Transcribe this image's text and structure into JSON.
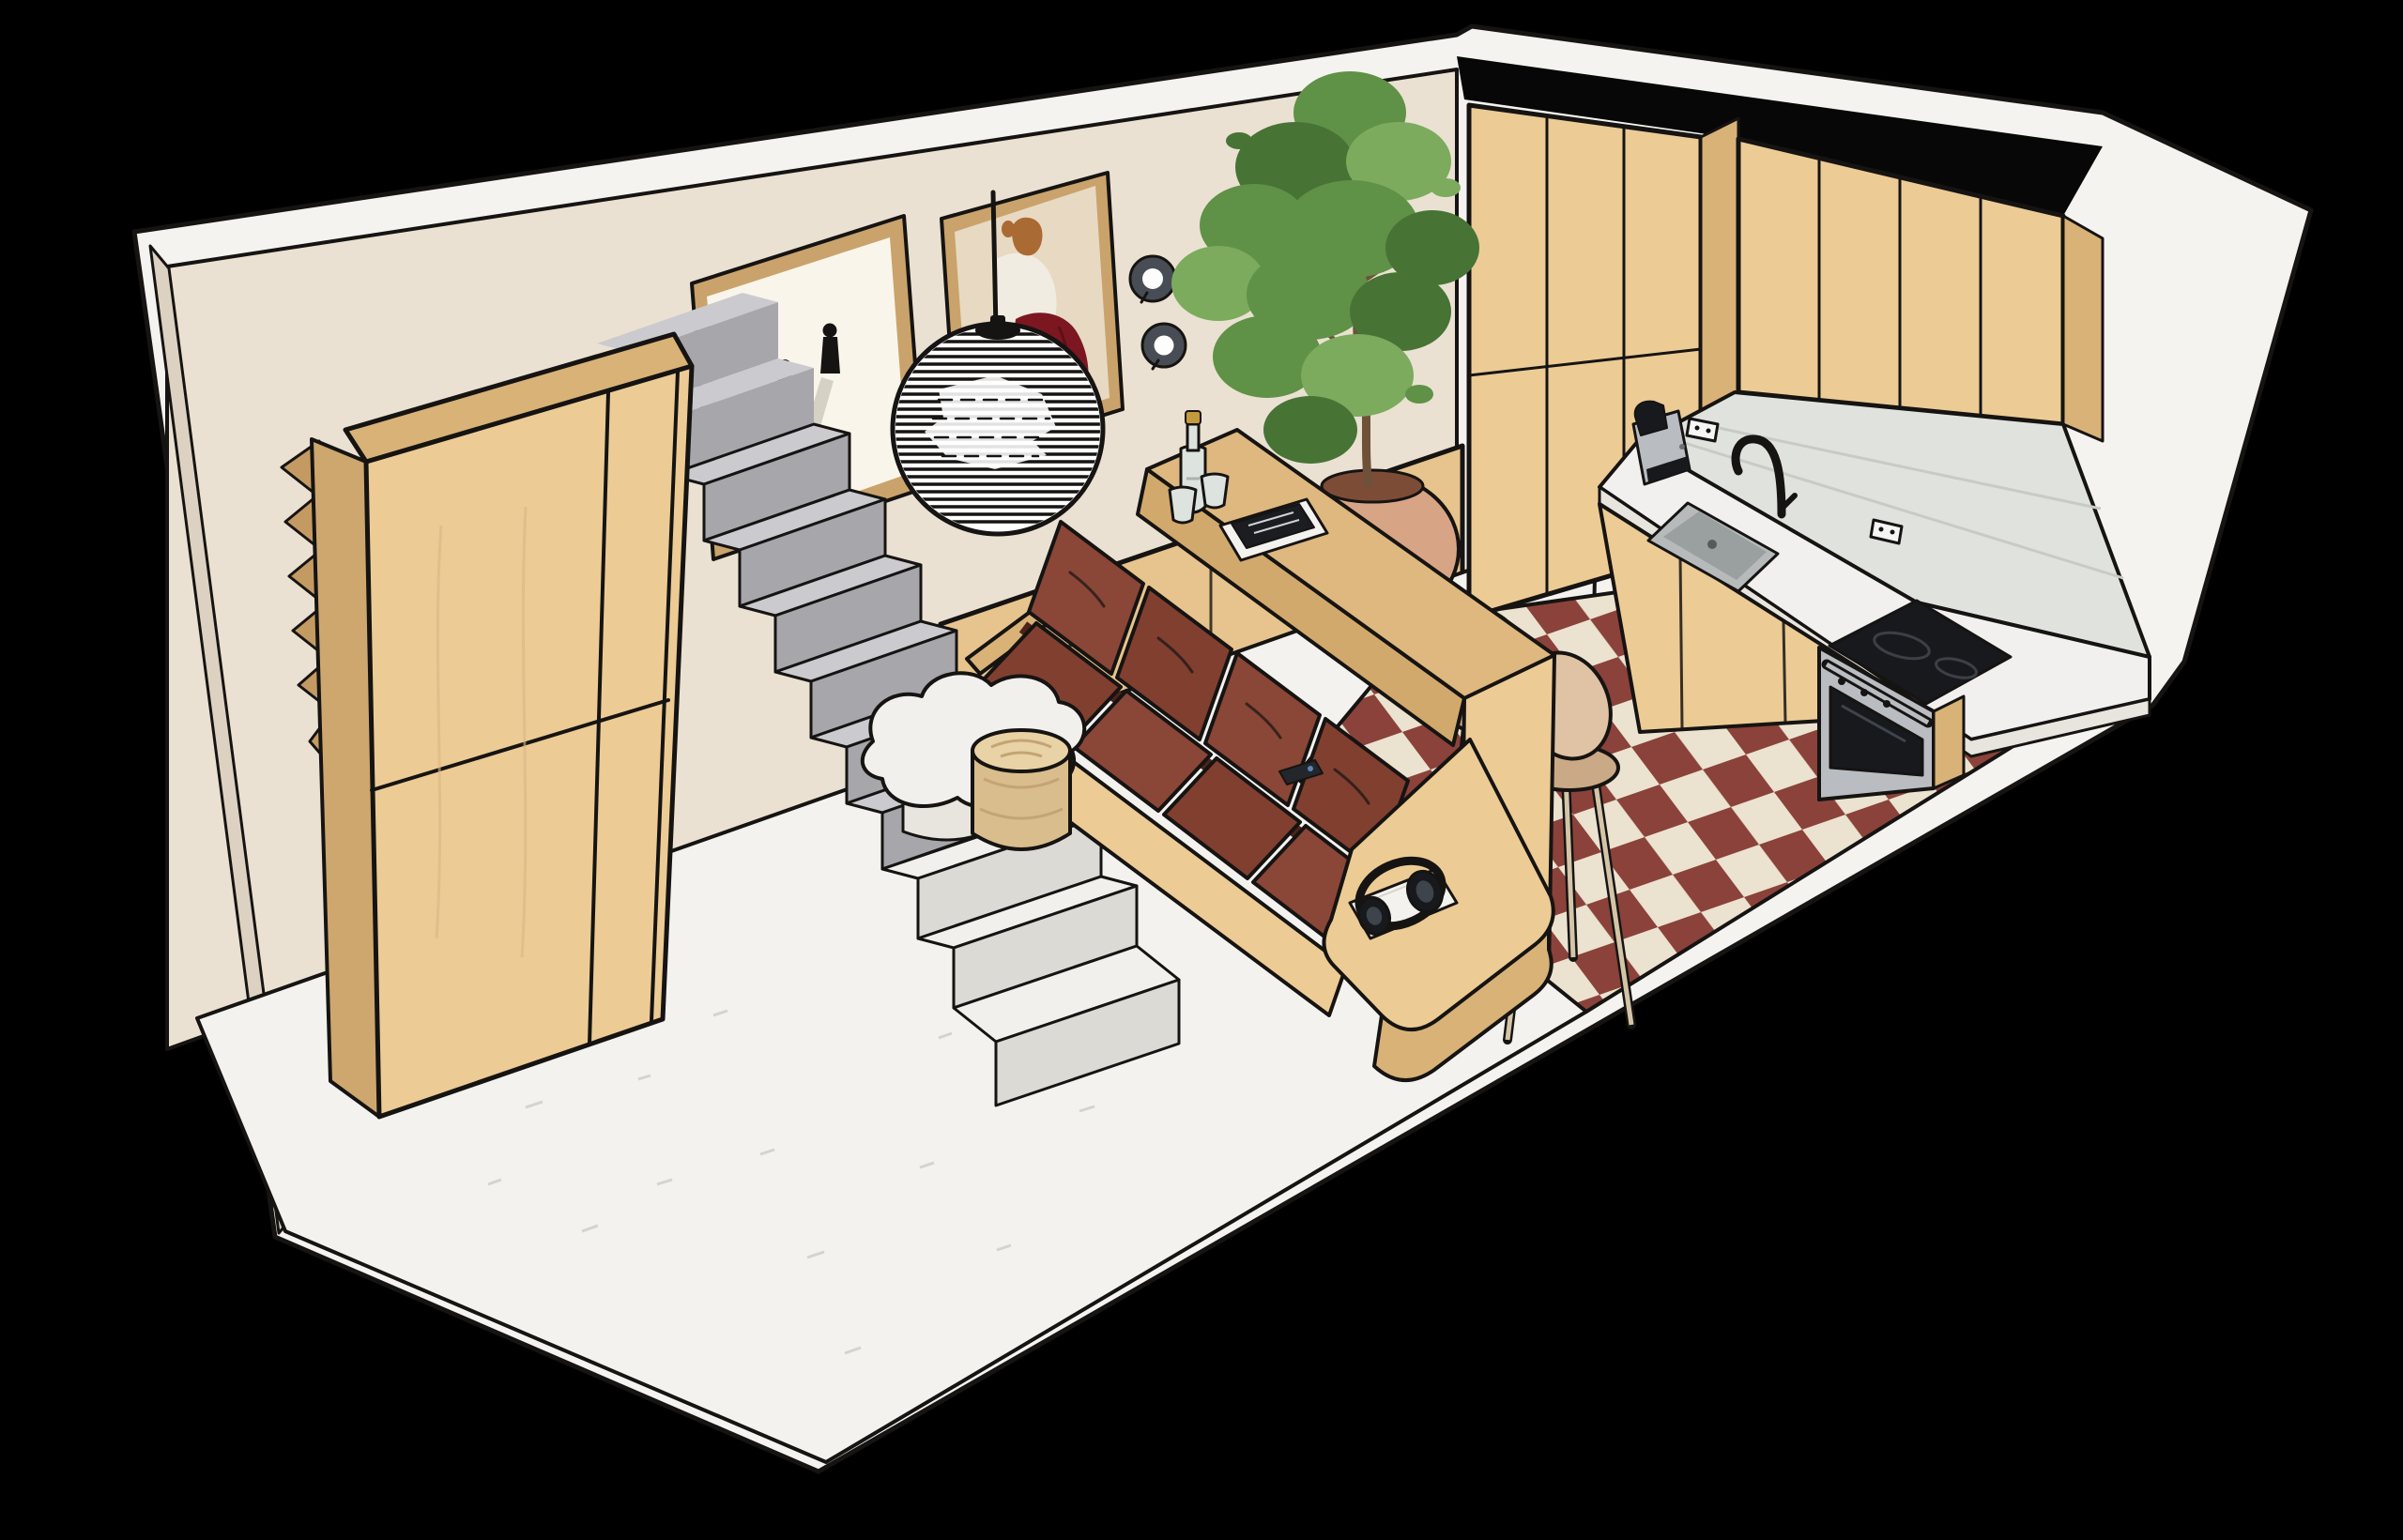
{
  "scene": {
    "title": "Axonometric cutaway rendering of a studio apartment interior with living area, staircase and kitchen",
    "background": "#000000",
    "view": "isometric cutaway from above"
  },
  "palette": {
    "ink": "#161412",
    "shell": "#f4f3f0",
    "wall": "#eae1d2",
    "wallSliver": "#ddd2c2",
    "blackBand": "#070707",
    "woodLight": "#eccb95",
    "woodMid": "#d9b277",
    "woodDark": "#c49a63",
    "woodSide": "#cda76e",
    "panelWood": "#e7c48e",
    "stairTop": "#cacacf",
    "stairRiser": "#a6a6ab",
    "stairWhite": "#f1f0ec",
    "stairWhiteRiser": "#dbdad5",
    "floorWhite": "#f3f2ef",
    "speckle": "#d5d3cd",
    "tileRed": "#8a423a",
    "tileCream": "#ebe2d0",
    "counterTopWood": "#deb87f",
    "counterFrontWood": "#d2a96c",
    "tableWhite": "#f2f0ed",
    "tableSide": "#e8e5df",
    "poufTop": "#e8d2a6",
    "poufSide": "#d9bd8c",
    "poufGrain": "#c4a474",
    "sofaRed": "#8a4637",
    "sofaRedAlt": "#813f30",
    "sofaDeep": "#4f231a",
    "kitchenCounter": "#f1f0ee",
    "backsplash": "#e0e2dd",
    "tileLine": "#c8cbc5",
    "steel": "#b9bdc1",
    "applianceBlack": "#17191d",
    "sinkGray": "#b6baba",
    "sinkDeep": "#9aa0a0",
    "green": "#5f9147",
    "greenDark": "#477335",
    "greenLight": "#7cab5e",
    "trunk": "#6e5138",
    "potClay": "#d8a486",
    "potShade": "#bb8566",
    "potMouth": "#7c4c37",
    "stoolBeige": "#dfc3a4",
    "stoolShade": "#caa987",
    "stoolLeg": "#d4c5a8",
    "lampWhite": "#ffffff",
    "paper": "#f9f5eb",
    "paperShadow": "#b8b3a6",
    "frameWood": "#c9a36b",
    "artBg": "#e8d9c3",
    "skirtRed": "#7c1721",
    "hair": "#aa6a33",
    "figWhite": "#f1ece2",
    "sconceRing": "#484d55",
    "outlet": "#f5f5f3",
    "remoteBlack": "#23272c",
    "remoteDot": "#5b86b8",
    "bottleGlass": "#dde4e0",
    "bottleCap": "#c39a3c",
    "magWhite": "#f4f2ee",
    "magBlack": "#1b1d21",
    "headphone": "#17191d",
    "headphoneLight": "#3e444c",
    "grainLight": "#dcb684"
  },
  "room": {
    "walls": "cream plaster walls with white cut edges",
    "living_floor": "white speckled concrete floor",
    "kitchen_floor": "red and cream checkerboard tiles"
  },
  "objects": [
    {
      "id": "wardrobe",
      "label": "tall oak wardrobe beside staircase"
    },
    {
      "id": "staircase",
      "label": "grey steps with white base steps and sawtooth stringer"
    },
    {
      "id": "wall-paneling",
      "label": "oak wainscot panels under the stairs"
    },
    {
      "id": "artwork-figures",
      "label": "framed print of two small figures with long shadows"
    },
    {
      "id": "artwork-portrait",
      "label": "framed print of a seated figure in white top and red skirt"
    },
    {
      "id": "wall-sconces",
      "label": "two round dark wall spots"
    },
    {
      "id": "pendant-lamp",
      "label": "ribbed white sphere pendant lamp"
    },
    {
      "id": "sofa",
      "label": "brick-red four-seat sofa on oak platform"
    },
    {
      "id": "sofa-remote",
      "label": "remote control on seat"
    },
    {
      "id": "headphones",
      "label": "black headphones on a white book on the platform shelf"
    },
    {
      "id": "coffee-table",
      "label": "white cloud-shaped coffee table"
    },
    {
      "id": "pouf",
      "label": "cylindrical wooden side table"
    },
    {
      "id": "bar-counter",
      "label": "oak bar counter behind the sofa with bottle, two glasses and magazines"
    },
    {
      "id": "bar-stools",
      "label": "three beige bar stools with thin legs"
    },
    {
      "id": "plant",
      "label": "tall potted tree in round terracotta pot"
    },
    {
      "id": "kitchen-cabinets",
      "label": "oak tall, upper and base cabinets"
    },
    {
      "id": "kitchen-counter",
      "label": "white countertop with grey undermount sink"
    },
    {
      "id": "faucet",
      "label": "black gooseneck faucet"
    },
    {
      "id": "coffee-machine",
      "label": "grey capsule coffee machine"
    },
    {
      "id": "outlets",
      "label": "two wall outlets on backsplash"
    },
    {
      "id": "cooktop",
      "label": "black induction hob"
    },
    {
      "id": "oven",
      "label": "stainless built-in oven"
    }
  ]
}
